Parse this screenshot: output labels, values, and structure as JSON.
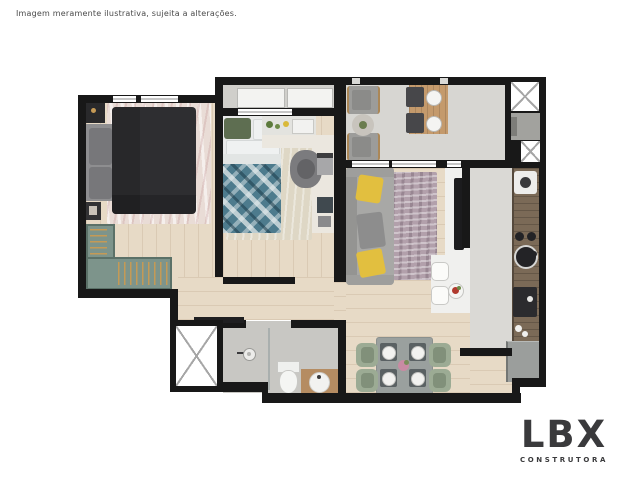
{
  "disclaimer": "Imagem meramente ilustrativa, sujeita a alterações.",
  "logo": {
    "brand": "LBX",
    "subtitle": "CONSTRUTORA"
  },
  "colors": {
    "background": "#ffffff",
    "wall": "#181818",
    "wood_floor": "#e7dac6",
    "balcony_floor": "#d7d6d2",
    "tech_floor": "#d0cfcb",
    "bath_floor": "#c8c7c3",
    "kitchen_floor": "#dad9d5",
    "closet_teal": "#7d948b",
    "hanger_tan": "#c59a55",
    "bed_dark": "#2e2e31",
    "rug_pink": "#e9dcd6",
    "rug_beige": "#ded7c5",
    "rug_mauve": "#b2a0ab",
    "sofa_gray": "#a8a8a6",
    "pillow_yellow": "#e2bf3f",
    "duvet_teal": "#4d7b8d",
    "counter_wood": "#7b6a57",
    "vanity_wood": "#b58c62",
    "appliance_gray": "#9b9e9c",
    "logo_color": "#3a3a3c",
    "text_color": "#4a4a4a"
  }
}
